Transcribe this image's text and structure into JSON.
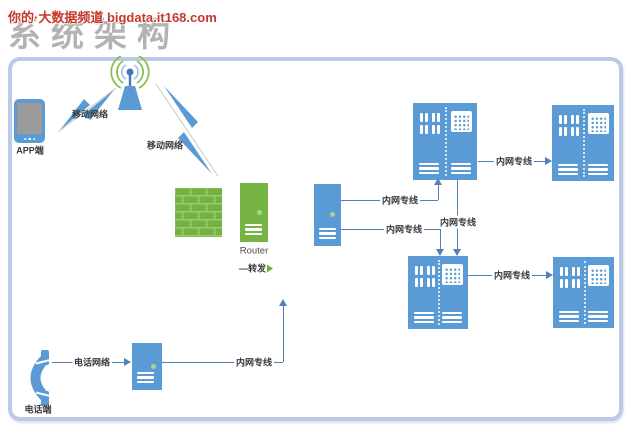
{
  "page": {
    "watermark": "你的·大数据频道 bigdata.it168.com",
    "title": "系统架构"
  },
  "colors": {
    "node_blue": "#5b9bd5",
    "node_green": "#76b543",
    "line_blue": "#4f81bd",
    "panel_border": "#b9cbe7",
    "watermark_red": "#c5382b",
    "title_gray": "#b3b3b3"
  },
  "nodes": {
    "app_terminal": {
      "label": "APP端",
      "icon": "smartphone-icon"
    },
    "cell_tower": {
      "icon": "antenna-icon"
    },
    "firewall": {
      "icon": "firewall-brick-icon"
    },
    "router": {
      "label": "Router",
      "action": "—转发",
      "icon": "server-tower-icon"
    },
    "gateway_server": {
      "icon": "server-tower-icon"
    },
    "voice_server": {
      "icon": "server-tower-icon"
    },
    "phone_terminal": {
      "label": "电话端",
      "icon": "telephone-handset-icon"
    },
    "rack_top_left": {
      "icon": "server-rack-icon"
    },
    "rack_top_right": {
      "icon": "server-rack-icon"
    },
    "rack_bottom_left": {
      "icon": "server-rack-icon"
    },
    "rack_bottom_right": {
      "icon": "server-rack-icon"
    }
  },
  "edges": {
    "app_mobile_link": {
      "label": "移动网络"
    },
    "tower_mobile_link": {
      "label": "移动网络"
    },
    "phone_to_voice_server": {
      "label": "电话网络"
    },
    "voice_server_uplink": {
      "label": "内网专线"
    },
    "gateway_to_rack_top": {
      "label": "内网专线"
    },
    "gateway_to_rack_bottom": {
      "label": "内网专线"
    },
    "rack_top_to_rack_bottom": {
      "label": "内网专线"
    },
    "rack_top_left_to_right": {
      "label": "内网专线"
    },
    "rack_bottom_left_to_right": {
      "label": "内网专线"
    }
  }
}
